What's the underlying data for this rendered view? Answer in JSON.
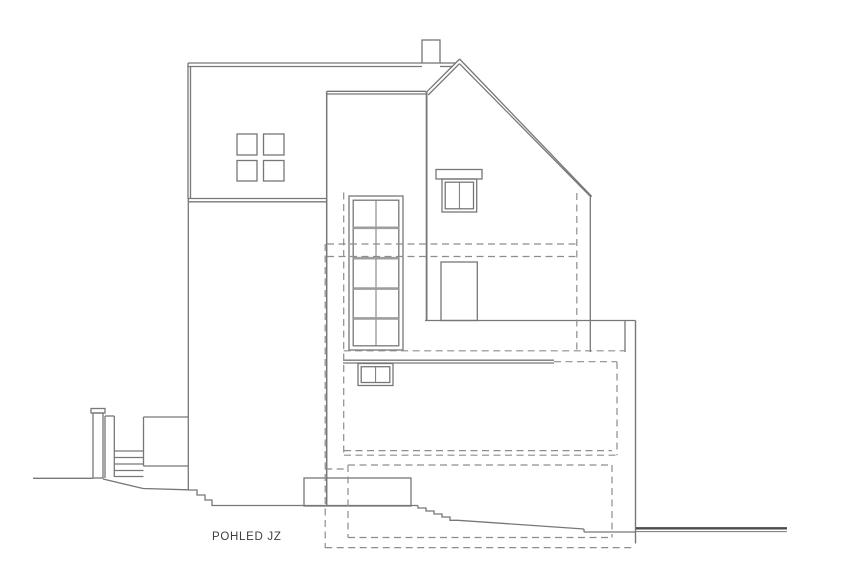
{
  "title": {
    "text": "POHLED JZ"
  },
  "palette": {
    "bg": "#ffffff",
    "line": "#777777",
    "line2": "#4a4a4a",
    "dash": "#8d8d8d",
    "bar": "#9e9e9e",
    "text": "#3d3d3d"
  },
  "drawing": {
    "width": 849,
    "height": 566,
    "stroke_width": 1.3,
    "dash_width": 1.2,
    "dash_pattern": "7 4.5",
    "rects": [
      [
        237,
        134,
        20,
        21,
        {
          "n": "rear-wing-window-1"
        }
      ],
      [
        263.5,
        134,
        20.5,
        21,
        {
          "n": "rear-wing-window-2"
        }
      ],
      [
        237,
        160.5,
        20,
        20.5,
        {
          "n": "rear-wing-window-3"
        }
      ],
      [
        263.5,
        160.5,
        20.5,
        20.5,
        {
          "n": "rear-wing-window-4"
        }
      ],
      [
        422,
        40,
        18,
        23,
        {
          "n": "chimney"
        }
      ],
      [
        436,
        169.5,
        46,
        9.5,
        {
          "n": "gable-window-lintel"
        }
      ],
      [
        442,
        179,
        34.7,
        33,
        {
          "n": "gable-window-frame"
        }
      ],
      [
        445.2,
        182.2,
        28.3,
        26.6,
        {
          "n": "gable-window-inner"
        }
      ],
      [
        349,
        196,
        54,
        154,
        {
          "n": "stair-window-frame"
        }
      ],
      [
        353.2,
        200.2,
        45.6,
        145.6,
        {
          "n": "stair-window-inner"
        }
      ],
      [
        441,
        262,
        36.3,
        58.5,
        {
          "n": "entrance-door"
        }
      ],
      [
        358,
        363.5,
        35,
        22,
        {
          "n": "terrace-window-frame"
        }
      ],
      [
        361.2,
        366.7,
        28.6,
        15.8,
        {
          "n": "terrace-window-inner"
        }
      ],
      [
        304,
        478,
        107,
        28,
        {
          "n": "porch-base"
        }
      ],
      [
        91,
        408.5,
        14,
        4.5,
        {
          "n": "gate-post-cap"
        }
      ],
      [
        93,
        413,
        10,
        65,
        {
          "n": "gate-post"
        }
      ]
    ],
    "lines": [
      [
        188,
        63,
        422,
        63,
        {
          "n": "rear-roof-edge"
        }
      ],
      [
        440,
        63,
        456,
        63,
        {
          "n": "rear-roof-edge"
        }
      ],
      [
        188,
        66.5,
        422,
        66.5,
        {
          "n": "rear-roof-edge-inner"
        }
      ],
      [
        440,
        66.5,
        453,
        66.5,
        {
          "n": "rear-roof-edge-inner"
        }
      ],
      [
        188,
        63,
        188,
        199,
        {
          "n": "rear-left-wall"
        }
      ],
      [
        190.5,
        66.5,
        190.5,
        199,
        {
          "n": "rear-left-wall-inner"
        }
      ],
      [
        188.3,
        199,
        188.3,
        490,
        {
          "n": "rear-left-wall-lower"
        }
      ],
      [
        188,
        198.5,
        326,
        198.5,
        {
          "n": "rear-eaves-band"
        }
      ],
      [
        188,
        201.8,
        326,
        201.8,
        {
          "n": "rear-eaves-band-inner"
        }
      ],
      [
        326.7,
        91.3,
        326.7,
        506,
        {
          "w": 1.5,
          "n": "tower-left-edge"
        }
      ],
      [
        327,
        91.3,
        426,
        91.3,
        {
          "n": "tower-top-edge"
        }
      ],
      [
        327,
        94,
        427.5,
        94,
        {
          "n": "tower-top-edge-inner"
        }
      ],
      [
        426.6,
        92,
        426.6,
        320.5,
        {
          "w": 1.8,
          "n": "tower-right-edge"
        }
      ],
      [
        459.6,
        59,
        425.8,
        92.8,
        {
          "n": "roof-left-slope"
        }
      ],
      [
        459.6,
        63.6,
        428.2,
        95,
        {
          "n": "roof-left-slope-inner"
        }
      ],
      [
        459.6,
        59,
        591.8,
        196.6,
        {
          "n": "roof-right-slope"
        }
      ],
      [
        459.6,
        63.8,
        590,
        196,
        {
          "n": "roof-right-slope-inner"
        }
      ],
      [
        590.3,
        196,
        590.3,
        352,
        {
          "n": "gable-right-wall"
        }
      ],
      [
        459.4,
        182.2,
        459.4,
        208.8,
        {
          "w": 1,
          "n": "gable-window-mullion"
        }
      ],
      [
        376,
        200.2,
        376,
        345.8,
        {
          "w": 1,
          "n": "stair-window-mullion"
        }
      ],
      [
        353.2,
        227.8,
        398.8,
        227.8,
        {
          "w": 2.6,
          "c": "bar",
          "n": "stair-window-bar"
        }
      ],
      [
        353.2,
        258.2,
        398.8,
        258.2,
        {
          "w": 2.6,
          "c": "bar",
          "n": "stair-window-bar"
        }
      ],
      [
        353.2,
        288.6,
        398.8,
        288.6,
        {
          "w": 2.6,
          "c": "bar",
          "n": "stair-window-bar"
        }
      ],
      [
        353.2,
        318.4,
        398.8,
        318.4,
        {
          "w": 2.6,
          "c": "bar",
          "n": "stair-window-bar"
        }
      ],
      [
        375.6,
        366.7,
        375.6,
        382.5,
        {
          "w": 1,
          "n": "terrace-window-mullion"
        }
      ],
      [
        425,
        320.5,
        635.5,
        320.5,
        {
          "n": "extension-roof-line"
        }
      ],
      [
        635.5,
        320.5,
        635.5,
        543.5,
        {
          "w": 1.4,
          "n": "extension-right-wall"
        }
      ],
      [
        625,
        320.5,
        625,
        352,
        {
          "n": "extension-corner-edge"
        }
      ],
      [
        343,
        360.2,
        554,
        360.2,
        {
          "n": "parapet-top"
        }
      ],
      [
        343,
        363,
        554,
        363,
        {
          "n": "parapet-top-inner"
        }
      ],
      [
        33,
        478.3,
        93,
        478.3,
        {
          "n": "ground-line-left"
        }
      ],
      [
        105,
        416,
        105,
        478,
        {
          "n": "fence-left-wall"
        }
      ],
      [
        114.3,
        416,
        114.3,
        477,
        {
          "n": "fence-left-wall-inner"
        }
      ],
      [
        105,
        416,
        114.3,
        416,
        {
          "n": "fence-left-top"
        }
      ],
      [
        114.3,
        451,
        143.5,
        451,
        {
          "n": "stair-tread"
        }
      ],
      [
        114.3,
        457.5,
        143.5,
        457.5,
        {
          "n": "stair-tread"
        }
      ],
      [
        114.3,
        464,
        143.5,
        464,
        {
          "n": "stair-tread"
        }
      ],
      [
        114.3,
        470.5,
        143.5,
        470.5,
        {
          "n": "stair-tread"
        }
      ],
      [
        114.3,
        476.5,
        143.5,
        476.5,
        {
          "n": "stair-tread"
        }
      ],
      [
        143.5,
        417,
        143.5,
        466,
        {
          "n": "fence-right-wall"
        }
      ],
      [
        143.5,
        417,
        188,
        417,
        {
          "n": "fence-right-top"
        }
      ],
      [
        143.5,
        466,
        188,
        466,
        {
          "n": "fence-lower-edge"
        }
      ],
      [
        218,
        505.5,
        418,
        505.5,
        {
          "n": "ground-line-mid"
        }
      ],
      [
        458,
        520.3,
        584,
        529,
        {
          "n": "ground-slope-right"
        }
      ],
      [
        584,
        529,
        584,
        532,
        {
          "n": "ground-step-right"
        }
      ],
      [
        584,
        532,
        635.5,
        532,
        {
          "n": "ground-line-at-wall"
        }
      ],
      [
        636,
        528.3,
        787,
        528.3,
        {
          "w": 2.3,
          "c": "line2",
          "n": "ground-datum-line"
        }
      ],
      [
        636,
        531.6,
        787,
        531.6,
        {
          "w": 1,
          "n": "ground-datum-line-inner"
        }
      ]
    ],
    "polylines": [
      {
        "pts": [
          [
            103,
            479
          ],
          [
            143,
            488.5
          ],
          [
            188,
            489.8
          ]
        ],
        "n": "ground-slope-left"
      },
      {
        "pts": [
          [
            188,
            490
          ],
          [
            197,
            490
          ],
          [
            197,
            495
          ],
          [
            205,
            495
          ],
          [
            205,
            500
          ],
          [
            212,
            500
          ],
          [
            212,
            505.5
          ],
          [
            218,
            505.5
          ]
        ],
        "n": "wall-base-steps"
      },
      {
        "pts": [
          [
            418,
            505.5
          ],
          [
            418,
            508
          ],
          [
            426,
            508
          ],
          [
            426,
            511
          ],
          [
            434,
            511
          ],
          [
            434,
            514
          ],
          [
            442,
            514
          ],
          [
            442,
            517
          ],
          [
            450,
            517
          ],
          [
            450,
            520.3
          ],
          [
            458,
            520.3
          ]
        ],
        "n": "terrain-steps"
      }
    ],
    "dashes": [
      [
        327,
        244,
        577,
        244,
        {
          "n": "floor-slab-line-upper"
        }
      ],
      [
        327,
        256.5,
        577,
        256.5,
        {
          "n": "floor-slab-line-lower"
        }
      ],
      [
        343.7,
        192.5,
        343.7,
        455.2,
        {
          "n": "hidden-edge-left"
        }
      ],
      [
        576.8,
        193,
        576.8,
        352,
        {
          "n": "hidden-edge-right"
        }
      ],
      [
        343.7,
        350.8,
        625,
        350.8,
        {
          "n": "hidden-floor-line"
        }
      ],
      [
        554,
        361.7,
        617,
        361.7,
        {
          "n": "demolition-outline-b-top"
        }
      ],
      [
        617,
        362,
        617,
        455.2,
        {
          "n": "demolition-outline-b-right"
        }
      ],
      [
        344,
        450.6,
        612,
        450.6,
        {
          "n": "demolition-outline-b-bottom-upper"
        }
      ],
      [
        344,
        455.2,
        617,
        455.2,
        {
          "n": "demolition-outline-b-bottom"
        }
      ],
      [
        348,
        465,
        612,
        465,
        {
          "n": "demolition-outline-c-top"
        }
      ],
      [
        612,
        465,
        612,
        537.5,
        {
          "n": "demolition-outline-c-right"
        }
      ],
      [
        348,
        537.5,
        612,
        537.5,
        {
          "n": "demolition-outline-c-bottom"
        }
      ],
      [
        348,
        465,
        348,
        537.5,
        {
          "n": "demolition-outline-c-left"
        }
      ],
      [
        325.2,
        244,
        325.2,
        548,
        {
          "n": "demolition-outline-d-left"
        }
      ],
      [
        325.2,
        547.6,
        635,
        547.6,
        {
          "n": "demolition-outline-d-bottom"
        }
      ],
      [
        325.2,
        469,
        348,
        469,
        {
          "n": "demolition-outline-d-link"
        }
      ]
    ]
  }
}
